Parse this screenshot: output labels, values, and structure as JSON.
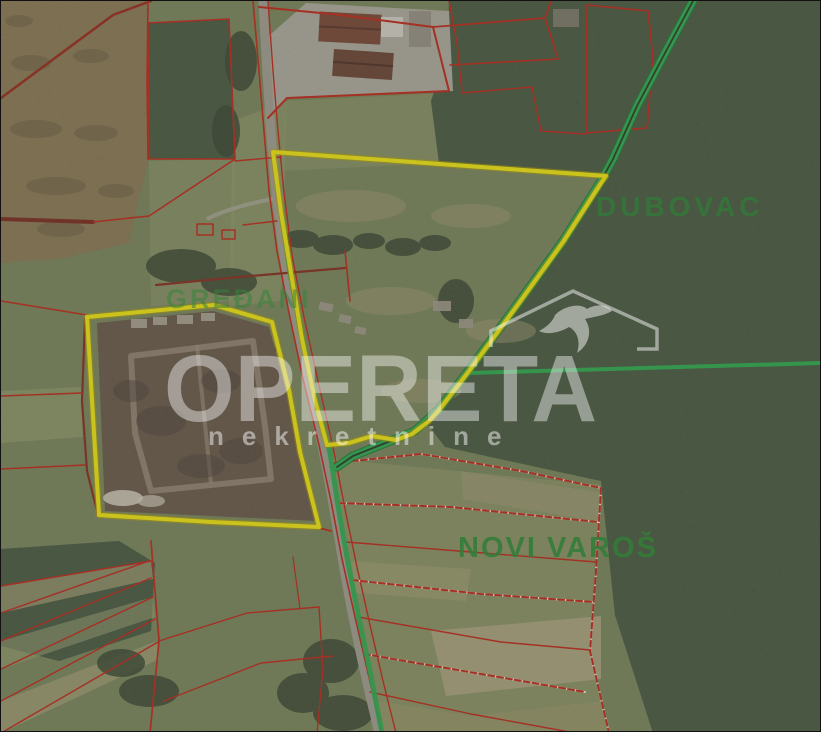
{
  "map": {
    "type": "satellite-cadastral-overlay",
    "place_labels": [
      {
        "id": "gredani",
        "text": "GREĐANI"
      },
      {
        "id": "dubovac",
        "text": "DUBOVAC"
      },
      {
        "id": "novi_varos",
        "text": "NOVI VAROŠ"
      }
    ],
    "watermark": {
      "brand": "OPERETA",
      "tagline": "nekretnine"
    },
    "features": {
      "highlighted_parcels_count": 2,
      "highlight_color": "#f8ec12",
      "cadastral_line_color": "#c5281a",
      "road_overlay_color": "#2fae52",
      "place_label_color": "#37813f",
      "watermark_color": "rgba(248,248,248,0.45)"
    }
  }
}
